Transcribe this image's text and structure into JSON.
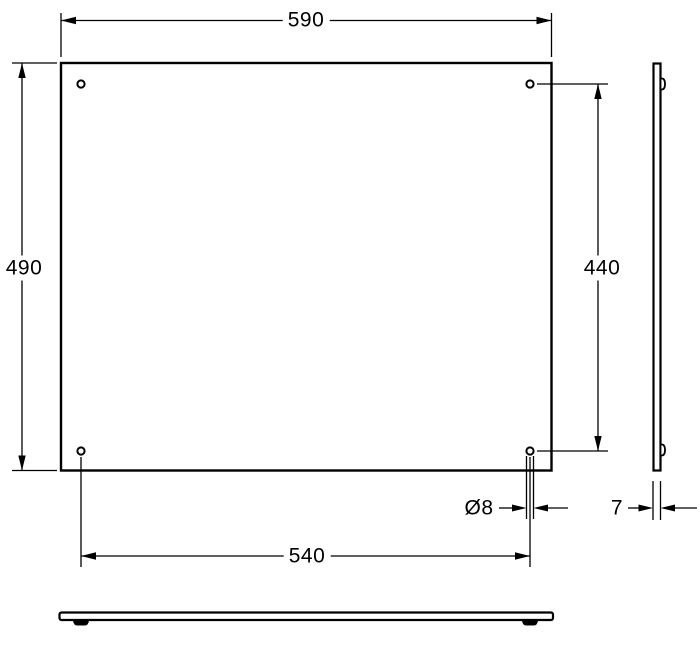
{
  "drawing": {
    "background_color": "#ffffff",
    "line_color": "#000000",
    "dimension_labels": {
      "overall_width": "590",
      "overall_height": "490",
      "hole_vertical_spacing": "440",
      "hole_horizontal_spacing": "540",
      "hole_diameter": "Ø8",
      "panel_thickness": "7"
    }
  }
}
